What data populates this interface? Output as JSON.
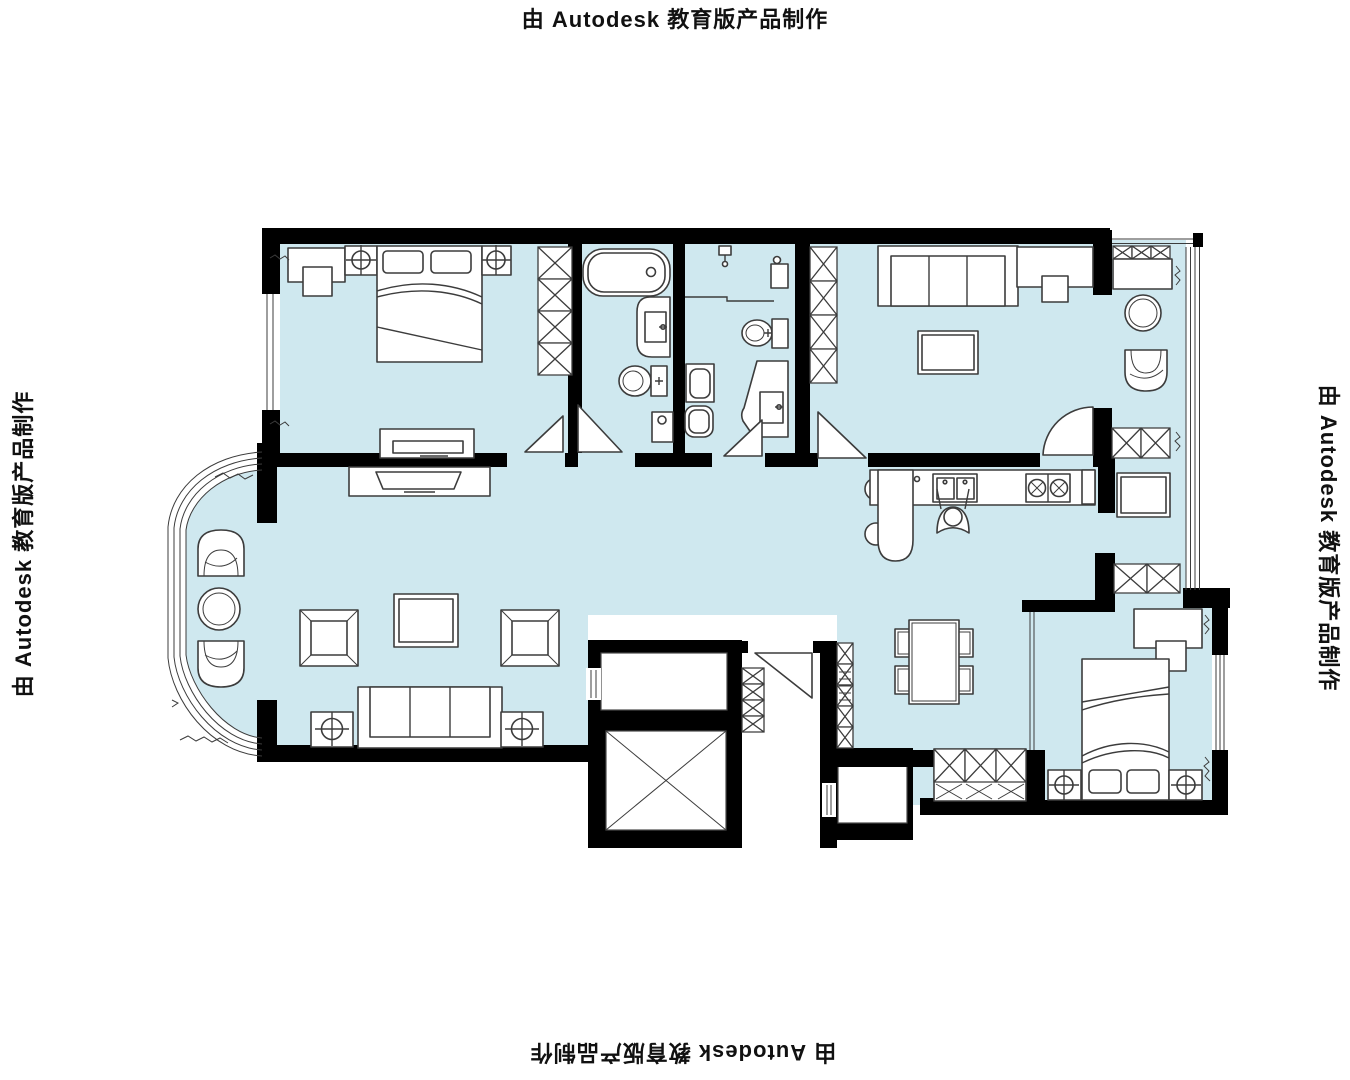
{
  "watermark": {
    "top": "由 Autodesk 教育版产品制作",
    "bottom": "由 Autodesk 教育版产品制作",
    "left": "由 Autodesk 教育版产品制作",
    "right": "由 Autodesk 教育版产品制作"
  },
  "colors": {
    "background": "#ffffff",
    "floor": "#cfe8ef",
    "wall": "#000000",
    "line": "#3c3c3c"
  },
  "plan": {
    "type": "residential-apartment-floor-plan",
    "symbols": [
      "double-bed",
      "pillow",
      "nightstand-with-lamp",
      "wardrobe-x-cabinet",
      "desk-with-chair",
      "tv-console",
      "bathtub",
      "toilet",
      "wash-basin",
      "shower-head",
      "washing-machine",
      "sofa-three-seat",
      "armchair",
      "coffee-table",
      "round-side-table",
      "dining-table-four-chairs",
      "kitchen-counter-double-sink",
      "cooktop-two-burners",
      "bar-counter-stools",
      "person-at-sink",
      "refrigerator",
      "sideboard-x-cabinet",
      "shoe-cabinet",
      "elevator-shaft-x",
      "door-swing-leaf",
      "window-glazing-lines",
      "bay-window"
    ]
  }
}
